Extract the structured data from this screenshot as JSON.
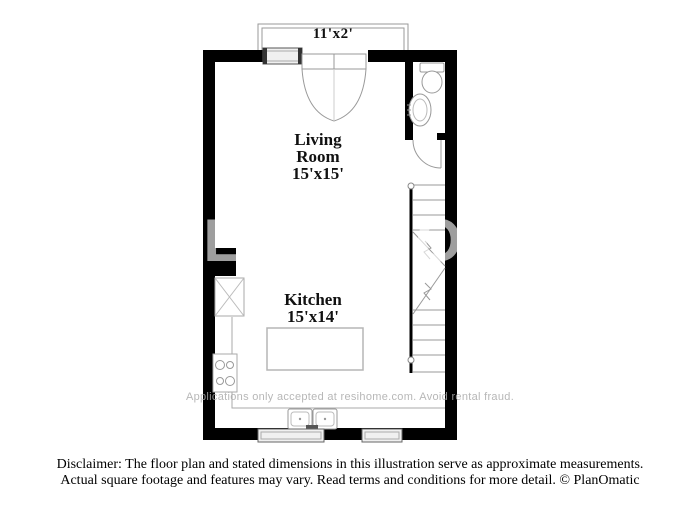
{
  "plan": {
    "balcony": {
      "dims": "11'x2'"
    },
    "living_room": {
      "name_line1": "Living",
      "name_line2": "Room",
      "dims": "15'x15'"
    },
    "kitchen": {
      "name": "Kitchen",
      "dims": "15'x14'"
    }
  },
  "watermarks": {
    "brand": "RESIHOME",
    "fraud": "Applications only accepted at resihome.com. Avoid rental fraud."
  },
  "disclaimer": {
    "line1": "Disclaimer: The floor plan and stated dimensions in this illustration serve as approximate measurements.",
    "line2": "Actual square footage and features may vary. Read terms and conditions for more detail. © PlanOmatic"
  },
  "colors": {
    "wall": "#000000",
    "fixture_outline": "#999999",
    "watermark_gray": "#ababab"
  }
}
